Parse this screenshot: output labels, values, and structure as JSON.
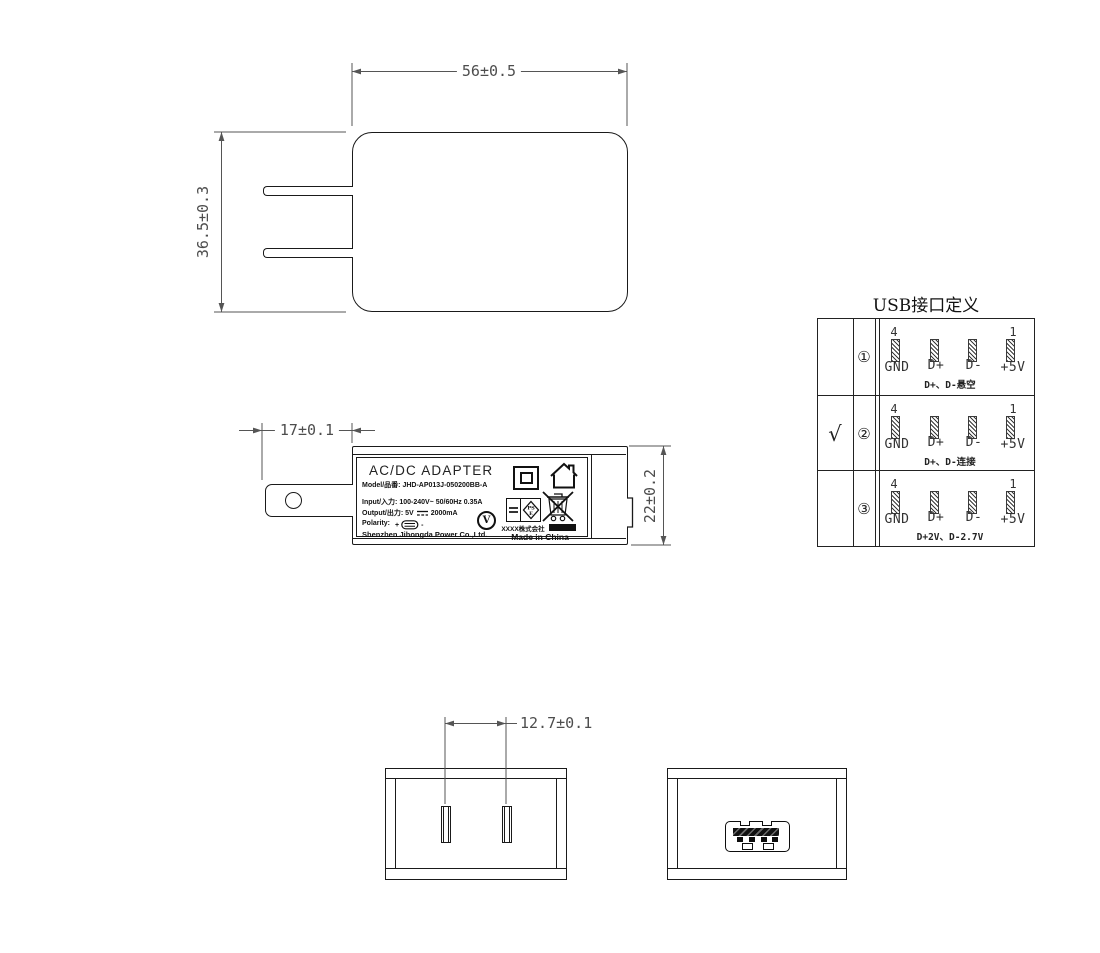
{
  "dimensions": {
    "top_width": "56±0.5",
    "side_height": "36.5±0.3",
    "prong_length": "17±0.1",
    "body_thickness": "22±0.2",
    "pin_pitch": "12.7±0.1"
  },
  "label": {
    "title": "AC/DC ADAPTER",
    "model_line": "Model/品番: JHD-AP013J-050200BB-A",
    "input_line": "Input/入力: 100-240V~ 50/60Hz 0.35A",
    "output_prefix": "Output/出力: 5V",
    "output_suffix": "2000mA",
    "polarity_prefix": "Polarity:",
    "plus": "+",
    "minus": "-",
    "company": "Shenzhen Jihongda Power Co.,Ltd.",
    "efficiency_mark": "V",
    "pse_mark_top": "PS",
    "pse_mark_bottom": "E",
    "pse_company": "XXXX株式会社",
    "made_in": "Made in China"
  },
  "usb_table": {
    "title": "USB接口定义",
    "rows": [
      {
        "selected": "",
        "index": "①",
        "pin_top_left": "4",
        "pin_top_right": "1",
        "pin_labels": [
          "GND",
          "D+",
          "D-",
          "+5V"
        ],
        "caption": "D+、D-悬空"
      },
      {
        "selected": "√",
        "index": "②",
        "pin_top_left": "4",
        "pin_top_right": "1",
        "pin_labels": [
          "GND",
          "D+",
          "D-",
          "+5V"
        ],
        "caption": "D+、D-连接"
      },
      {
        "selected": "",
        "index": "③",
        "pin_top_left": "4",
        "pin_top_right": "1",
        "pin_labels": [
          "GND",
          "D+",
          "D-",
          "+5V"
        ],
        "caption": "D+2V、D-2.7V"
      }
    ]
  }
}
